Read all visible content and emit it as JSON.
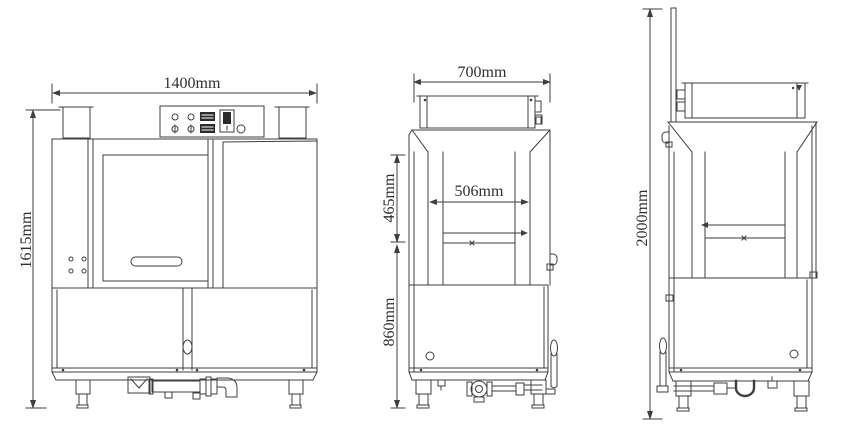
{
  "drawing": {
    "type": "technical-three-view",
    "subject": "hood-type dishwasher dimensional drawing",
    "line_color": "#3f3f3f",
    "text_color": "#2f2f2f",
    "background_color": "#ffffff",
    "views": {
      "front": {
        "name": "front-view",
        "width_label": "1400mm",
        "height_label": "1615mm"
      },
      "side_closed": {
        "name": "side-view-hood-closed",
        "width_label": "700mm",
        "chamber_width_label": "506mm",
        "opening_height_label": "465mm",
        "base_height_label": "860mm"
      },
      "side_raised": {
        "name": "side-view-hood-raised",
        "height_label": "2000mm"
      }
    }
  }
}
